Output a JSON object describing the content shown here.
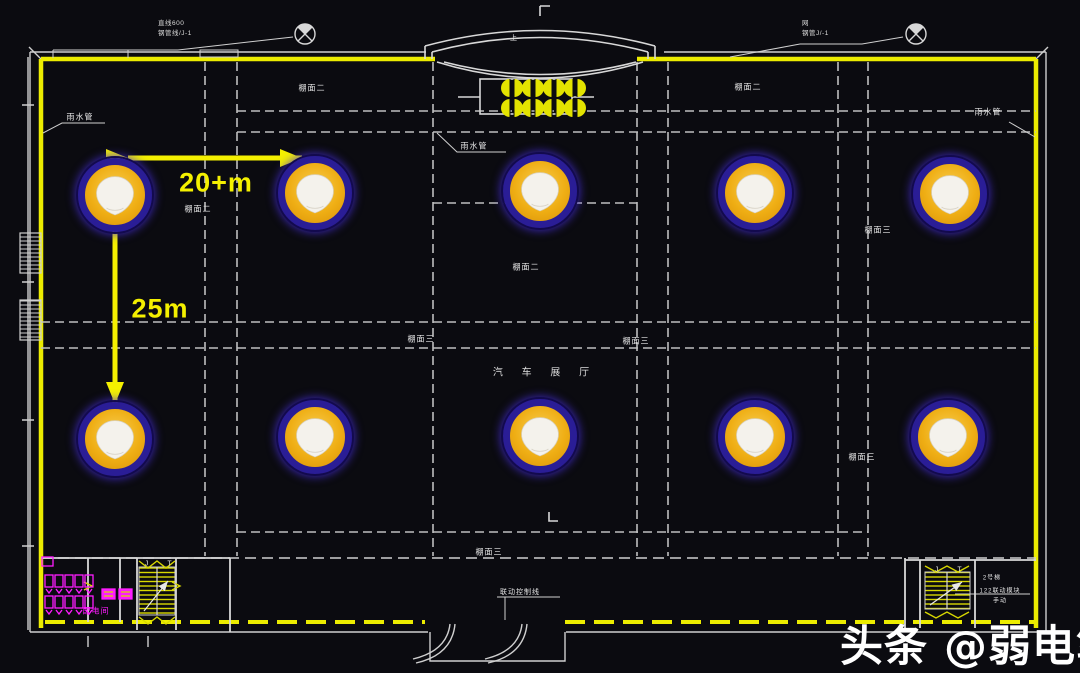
{
  "colors": {
    "background": "#0b0b10",
    "wall_yellow": "#ecec00",
    "line_white": "#d8d8d8",
    "grid_gray": "#bfbfbf",
    "magenta": "#ff1cff",
    "dimension_yellow": "#f4f000",
    "ap_ring_blue": "#2a1d96",
    "ap_body_orange": "#efae14"
  },
  "plan": {
    "hall_label": "汽 车 展 厅",
    "dimensions": {
      "horizontal": "20+m",
      "vertical": "25m"
    },
    "annotations": {
      "top_left_line1": "直线600",
      "top_left_line2": "钢管线/J-1",
      "top_right_line1": "网",
      "top_right_line2": "钢管J/-1"
    },
    "access_points": [
      {
        "x": 115,
        "y": 195
      },
      {
        "x": 315,
        "y": 193
      },
      {
        "x": 540,
        "y": 191
      },
      {
        "x": 755,
        "y": 193
      },
      {
        "x": 950,
        "y": 194
      },
      {
        "x": 115,
        "y": 439
      },
      {
        "x": 315,
        "y": 437
      },
      {
        "x": 540,
        "y": 436
      },
      {
        "x": 755,
        "y": 437
      },
      {
        "x": 948,
        "y": 437
      }
    ],
    "labels": [
      {
        "text": "雨水管",
        "x": 80,
        "y": 117
      },
      {
        "text": "雨水管",
        "x": 474,
        "y": 146
      },
      {
        "text": "雨水管",
        "x": 988,
        "y": 112
      },
      {
        "text": "棚面二",
        "x": 312,
        "y": 88
      },
      {
        "text": "棚面二",
        "x": 748,
        "y": 87
      },
      {
        "text": "棚面二",
        "x": 198,
        "y": 209
      },
      {
        "text": "棚面二",
        "x": 966,
        "y": 213
      },
      {
        "text": "棚面三",
        "x": 878,
        "y": 230
      },
      {
        "text": "棚面二",
        "x": 526,
        "y": 267
      },
      {
        "text": "棚面三",
        "x": 421,
        "y": 339
      },
      {
        "text": "棚面三",
        "x": 636,
        "y": 341
      },
      {
        "text": "棚面二",
        "x": 113,
        "y": 464
      },
      {
        "text": "灯",
        "x": 729,
        "y": 453,
        "size": 7
      },
      {
        "text": "棚面三",
        "x": 862,
        "y": 457
      },
      {
        "text": "棚面三",
        "x": 489,
        "y": 552
      },
      {
        "text": "联动控制线",
        "x": 520,
        "y": 592,
        "size": 7
      },
      {
        "text": "2号梯",
        "x": 992,
        "y": 577,
        "size": 6
      },
      {
        "text": "122联动模块",
        "x": 1000,
        "y": 590,
        "size": 6
      },
      {
        "text": "手动",
        "x": 1000,
        "y": 600,
        "size": 6
      },
      {
        "text": "J",
        "x": 147,
        "y": 564,
        "size": 7
      },
      {
        "text": "T",
        "x": 170,
        "y": 564,
        "size": 7
      },
      {
        "text": "J",
        "x": 937,
        "y": 570,
        "size": 7
      },
      {
        "text": "T",
        "x": 960,
        "y": 570,
        "size": 7
      },
      {
        "text": "上",
        "x": 514,
        "y": 38,
        "size": 7
      },
      {
        "text": "配电间",
        "x": 96,
        "y": 611,
        "size": 8,
        "color": "#ff1cff"
      }
    ]
  },
  "watermark": {
    "prefix": "头条 ",
    "handle": "@弱电笔记"
  }
}
